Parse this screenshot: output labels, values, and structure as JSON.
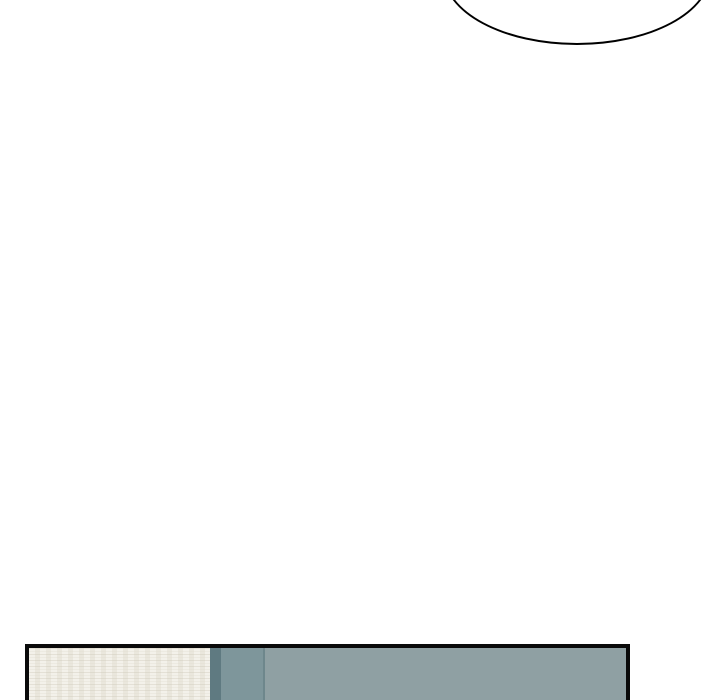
{
  "page": {
    "background": "#ffffff"
  },
  "speech_bubble": {
    "text": "",
    "fill": "#ffffff",
    "stroke": "#141414"
  },
  "panel": {
    "border_color": "#0a0a0a",
    "sections": {
      "wall_cream": {
        "color": "#efece3"
      },
      "frame_dark": {
        "color": "#5f7a81"
      },
      "door_mid": {
        "color": "#7e969b"
      },
      "seam": {
        "color": "#6e878c"
      },
      "wall_gray": {
        "color": "#8fa0a3"
      }
    }
  }
}
